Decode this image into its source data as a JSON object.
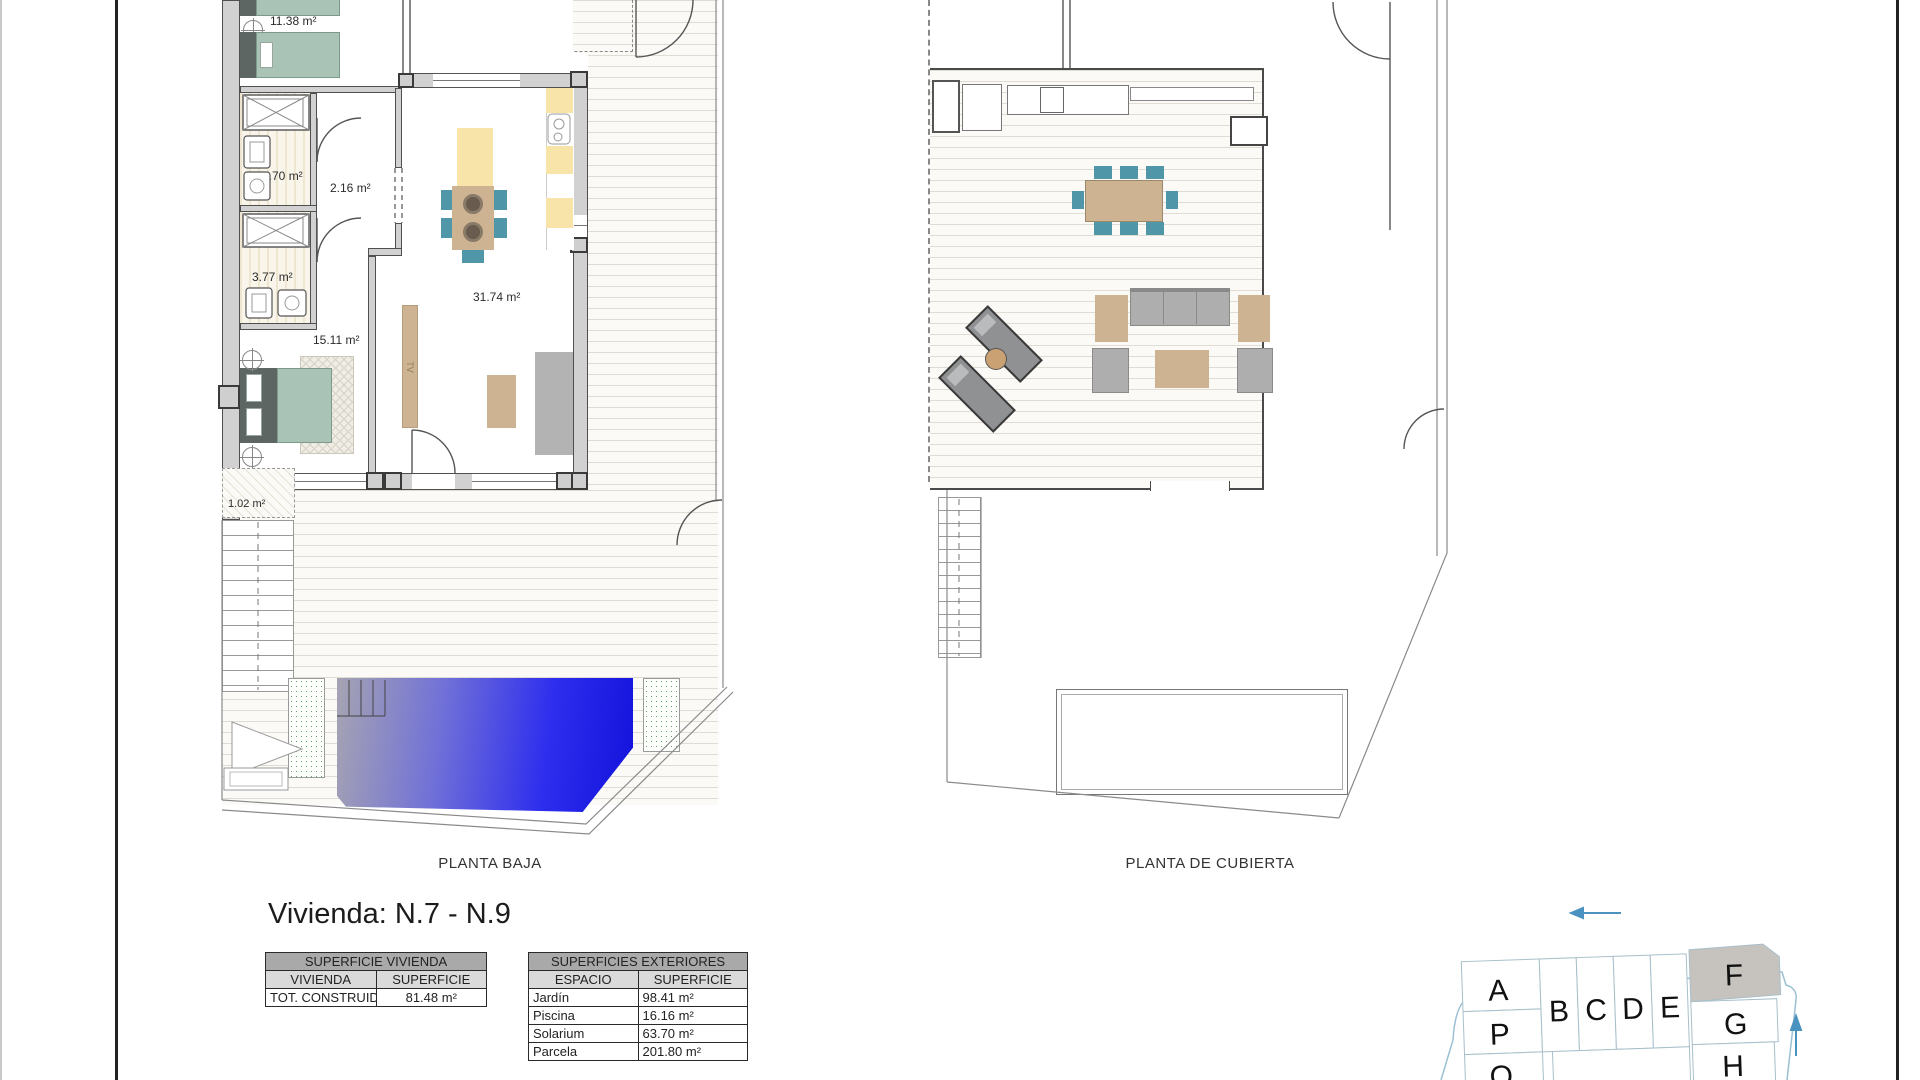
{
  "title": "Vivienda: N.7 - N.9",
  "plans": {
    "baja": {
      "caption": "PLANTA BAJA",
      "rooms": [
        {
          "name": "dormitorio-2",
          "area": "11.38 m²"
        },
        {
          "name": "bano-1",
          "area": "3.70 m²"
        },
        {
          "name": "distribuidor",
          "area": "2.16 m²"
        },
        {
          "name": "bano-2",
          "area": "3.77 m²"
        },
        {
          "name": "dormitorio-principal",
          "area": "15.11 m²"
        },
        {
          "name": "salon-comedor-cocina",
          "area": "31.74 m²"
        },
        {
          "name": "lavadero",
          "area": "1.02 m²"
        }
      ],
      "tv_label": "TV"
    },
    "cubierta": {
      "caption": "PLANTA DE CUBIERTA"
    }
  },
  "tables": {
    "vivienda": {
      "title": "SUPERFICIE VIVIENDA",
      "columns": [
        "VIVIENDA",
        "SUPERFICIE"
      ],
      "rows": [
        {
          "label": "TOT. CONSTRUIDA",
          "value": "81.48 m²"
        }
      ]
    },
    "exteriores": {
      "title": "SUPERFICIES EXTERIORES",
      "columns": [
        "ESPACIO",
        "SUPERFICIE"
      ],
      "rows": [
        {
          "label": "Jardín",
          "value": "98.41 m²"
        },
        {
          "label": "Piscina",
          "value": "16.16 m²"
        },
        {
          "label": "Solarium",
          "value": "63.70 m²"
        },
        {
          "label": "Parcela",
          "value": "201.80 m²"
        }
      ]
    }
  },
  "site_plan": {
    "units": [
      "A",
      "B",
      "C",
      "D",
      "E",
      "F",
      "G",
      "H",
      "P",
      "Q"
    ],
    "highlighted_unit": "F"
  },
  "colors": {
    "pool_blue": "#1b1bea",
    "chair_teal": "#4f96a8",
    "wood_tan": "#cdb391",
    "counter_yellow": "#f8e4a8",
    "bed_sage": "#a9c4b6",
    "site_outline": "#9cc0d3",
    "arrow_blue": "#4a93c0",
    "highlight_gray": "#c6c3bf"
  }
}
